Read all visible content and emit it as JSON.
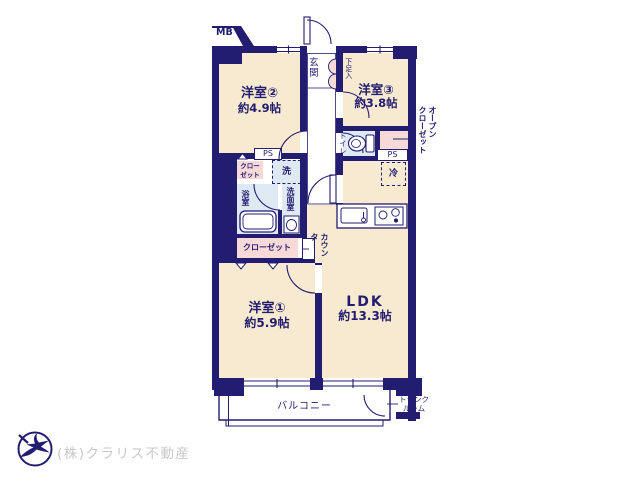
{
  "colors": {
    "wall": "#221d70",
    "room_fill": "#f8ead0",
    "wet_area_fill": "#dfe9f4",
    "closet_fill": "#f7d9d8",
    "logo_text_gray": "#c8c8c8",
    "background": "#ffffff"
  },
  "labels": {
    "mb": "MB",
    "entrance": "玄関",
    "shoe_cabinet": "下足入",
    "room2_name": "洋室②",
    "room2_size": "約4.9帖",
    "room3_name": "洋室③",
    "room3_size": "約3.8帖",
    "room1_name": "洋室①",
    "room1_size": "約5.9帖",
    "ldk_name": "LDK",
    "ldk_size": "約13.3帖",
    "toilet": "トイレ",
    "bathroom": "浴室",
    "washroom": "洗面室",
    "washing_machine": "洗",
    "refrigerator": "冷",
    "closet_upper": "クロー\nゼット",
    "closet_lower": "クローゼット",
    "open_closet": "オープン\nクローゼット",
    "counter": "カウン\nター",
    "ps_left": "PS",
    "ps_right": "PS",
    "balcony": "バルコニー",
    "trunk_room": "トランク\nルーム",
    "company": "(株)クラリス不動産"
  }
}
